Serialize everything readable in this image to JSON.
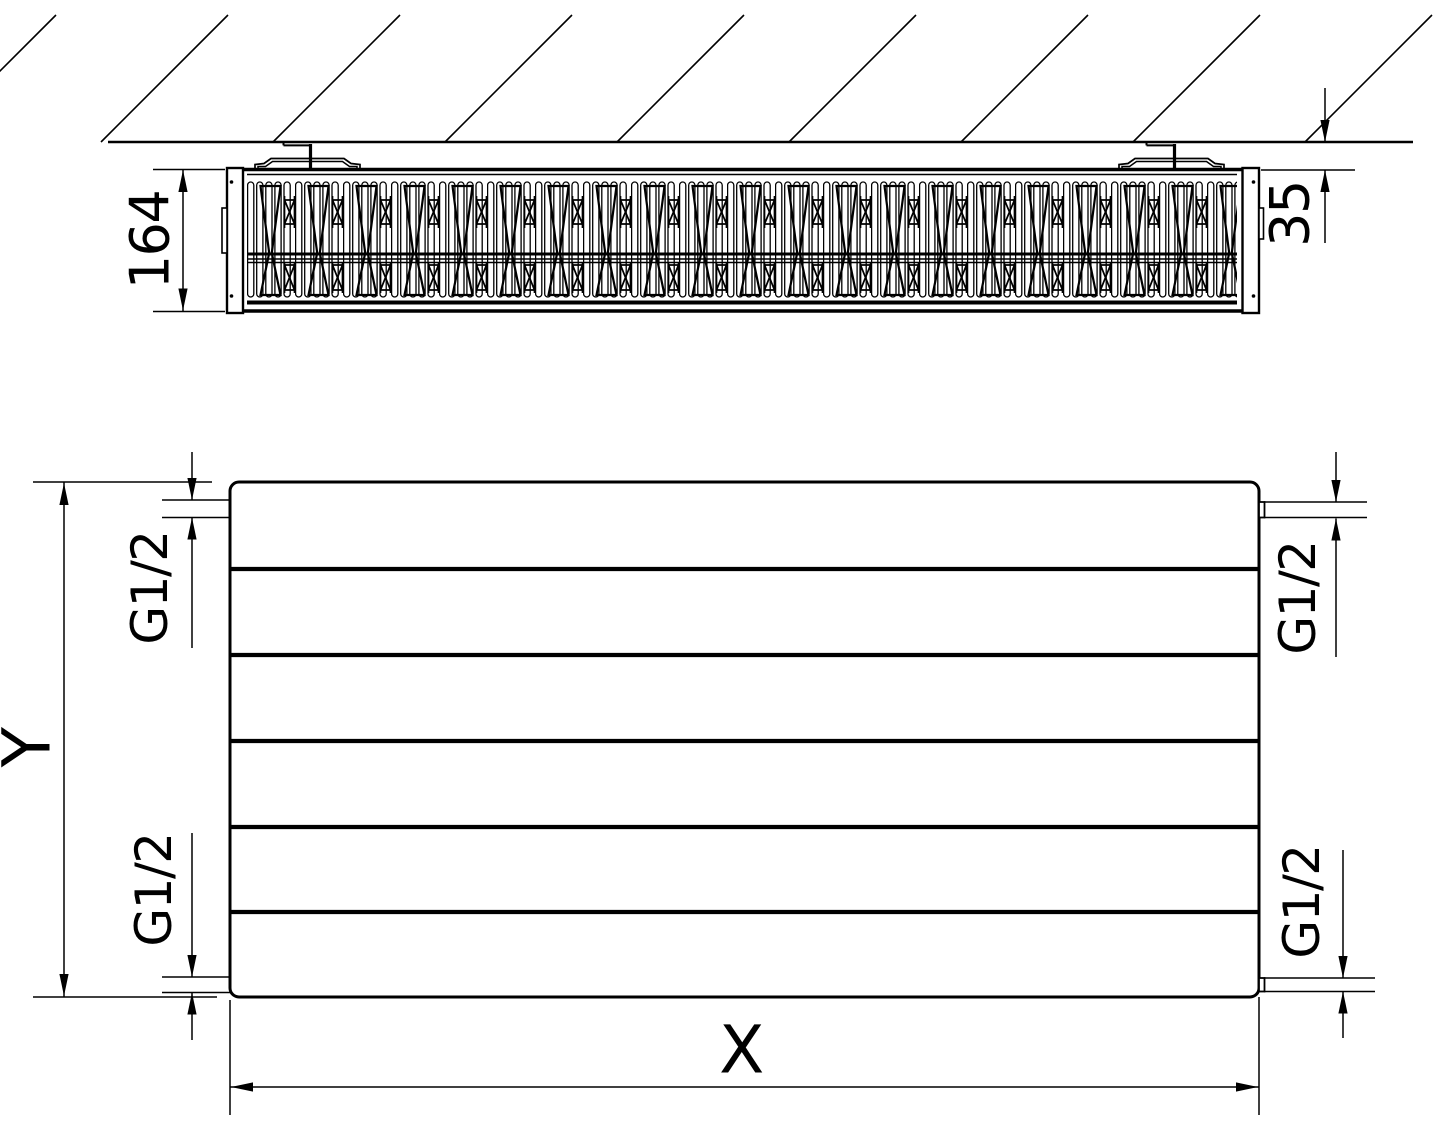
{
  "page": {
    "background_color": "#ffffff",
    "line_color": "#000000"
  },
  "views": {
    "top_view": {
      "title": "radiator-top-section-view",
      "depth_dimension": "164",
      "wall_clearance_dimension": "35"
    },
    "front_view": {
      "title": "radiator-front-view",
      "height_dimension_label": "Y",
      "width_dimension_label": "X",
      "connections": {
        "top_left_thread": "G1/2",
        "top_right_thread": "G1/2",
        "bottom_left_thread": "G1/2",
        "bottom_right_thread": "G1/2"
      }
    }
  }
}
